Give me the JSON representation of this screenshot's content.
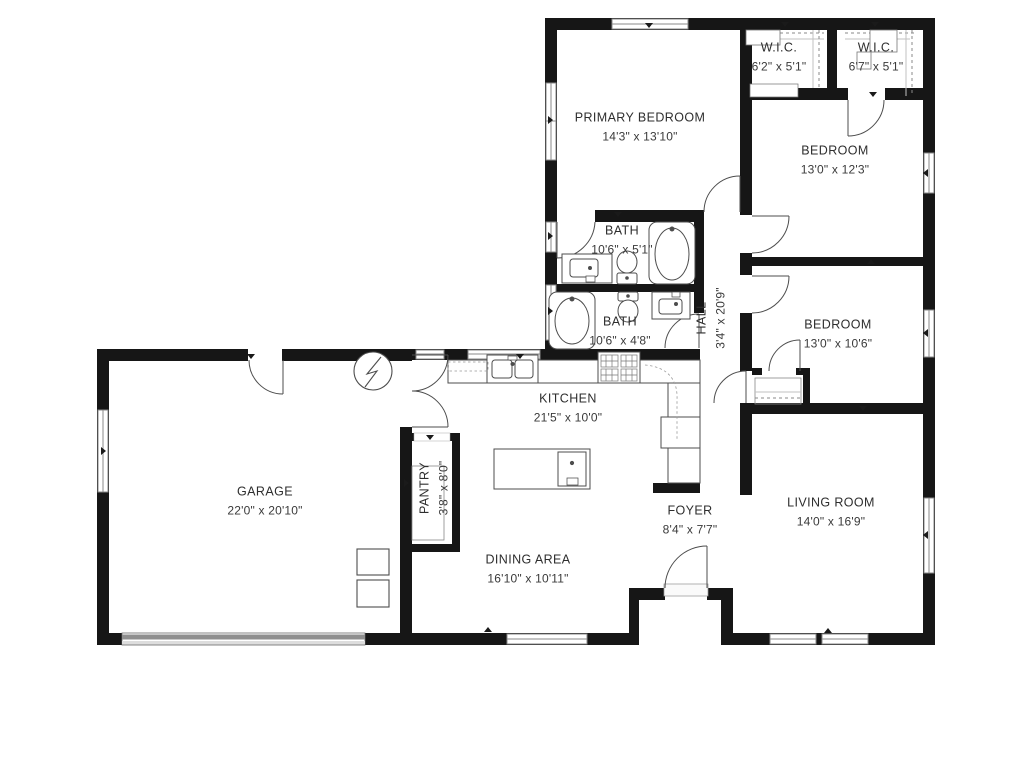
{
  "plan_title": "Single-story house floor plan",
  "colors": {
    "wall": "#161616",
    "fixture_stroke": "#4d4d4d",
    "window_stroke": "#8a8a8a",
    "garage_door_dark": "#8f8f8f",
    "garage_door_light": "#dddddd",
    "background": "#ffffff"
  },
  "rooms": [
    {
      "id": "wic-1",
      "name": "W.I.C.",
      "dims": "6'2\" x 5'1\""
    },
    {
      "id": "wic-2",
      "name": "W.I.C.",
      "dims": "6'7\" x 5'1\""
    },
    {
      "id": "primary-bedroom",
      "name": "PRIMARY BEDROOM",
      "dims": "14'3\" x 13'10\""
    },
    {
      "id": "bedroom-1",
      "name": "BEDROOM",
      "dims": "13'0\" x 12'3\""
    },
    {
      "id": "bath-1",
      "name": "BATH",
      "dims": "10'6\" x 5'1\""
    },
    {
      "id": "bath-2",
      "name": "BATH",
      "dims": "10'6\" x 4'8\""
    },
    {
      "id": "hall",
      "name": "HALL",
      "dims": "3'4\" x 20'9\""
    },
    {
      "id": "bedroom-2",
      "name": "BEDROOM",
      "dims": "13'0\" x 10'6\""
    },
    {
      "id": "kitchen",
      "name": "KITCHEN",
      "dims": "21'5\" x 10'0\""
    },
    {
      "id": "garage",
      "name": "GARAGE",
      "dims": "22'0\" x 20'10\""
    },
    {
      "id": "pantry",
      "name": "PANTRY",
      "dims": "3'8\" x 8'0\""
    },
    {
      "id": "dining-area",
      "name": "DINING AREA",
      "dims": "16'10\" x 10'11\""
    },
    {
      "id": "foyer",
      "name": "FOYER",
      "dims": "8'4\" x 7'7\""
    },
    {
      "id": "living-room",
      "name": "LIVING ROOM",
      "dims": "14'0\" x 16'9\""
    }
  ],
  "symbols": [
    "window-icon",
    "door-swing-icon",
    "garage-door-icon",
    "water-heater-icon",
    "bathtub-icon",
    "toilet-icon",
    "sink-icon",
    "range-icon",
    "refrigerator-icon",
    "kitchen-island-icon",
    "closet-rod-icon",
    "appliance-icon",
    "direction-marker-icon"
  ]
}
